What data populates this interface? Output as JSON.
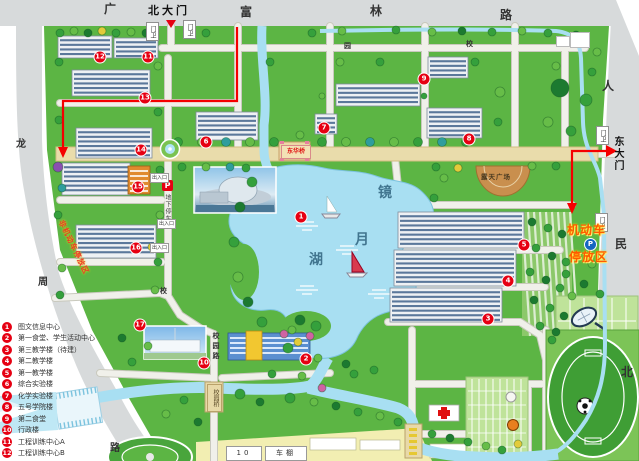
{
  "map": {
    "roads": {
      "guang": "广",
      "fulin": [
        "富",
        "林",
        "路"
      ],
      "renmin": [
        "人",
        "民",
        "北"
      ],
      "long": [
        "龙",
        "周",
        "路"
      ],
      "campus_top": [
        "校",
        "园"
      ],
      "campus_west": "校",
      "campus_south": "校园路"
    },
    "gates": {
      "north": "北大门",
      "east": "东大门",
      "guard": "门卫"
    },
    "bridges": {
      "donghua": "东华桥",
      "south": "校园桥"
    },
    "lake": [
      "镜",
      "月",
      "湖"
    ],
    "labels": {
      "plaza": "露天广场",
      "p": "P",
      "underground_parking": "地下停车场",
      "motor1": "机动车",
      "motor2": "停放区",
      "nonmotor": "非机动车停放区",
      "shed": "车棚",
      "shed_no": "10",
      "exit": "出入口"
    },
    "marker_nums": [
      "1",
      "2",
      "3",
      "4",
      "5",
      "6",
      "7",
      "8",
      "9",
      "10",
      "11",
      "12",
      "13",
      "14",
      "15",
      "16",
      "17"
    ]
  },
  "legend": {
    "items": [
      {
        "num": "1",
        "label": "图文信息中心"
      },
      {
        "num": "2",
        "label": "第一食堂、学生活动中心"
      },
      {
        "num": "3",
        "label": "第三教学楼（待建）"
      },
      {
        "num": "4",
        "label": "第二教学楼"
      },
      {
        "num": "5",
        "label": "第一教学楼"
      },
      {
        "num": "6",
        "label": "综合实验楼"
      },
      {
        "num": "7",
        "label": "化学实验楼"
      },
      {
        "num": "8",
        "label": "五号学院楼"
      },
      {
        "num": "9",
        "label": "第二食堂"
      },
      {
        "num": "10",
        "label": "行政楼"
      },
      {
        "num": "11",
        "label": "工程训练中心A"
      },
      {
        "num": "12",
        "label": "工程训练中心B"
      }
    ]
  },
  "colors": {
    "marker": "#e60012",
    "route": "#f50000",
    "water": "#a8dff2",
    "grass": "#5cb544",
    "road": "#d7dadb",
    "inner_road": "#f0f0ea",
    "tan_road": "#e9dcab",
    "lake_text": "#41758f",
    "orange_text": "#ff5a00"
  }
}
